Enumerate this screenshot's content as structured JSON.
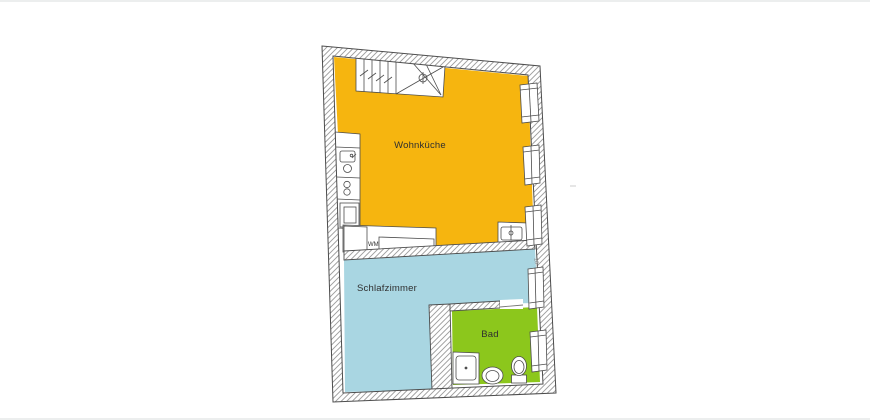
{
  "rooms": [
    {
      "label": "Wohnküche",
      "color": "#F6B50F"
    },
    {
      "label": "Schlafzimmer",
      "color": "#A9D6E2"
    },
    {
      "label": "Bad",
      "color": "#8CC71C"
    }
  ],
  "annotations": {
    "washing_machine": "WM",
    "wall_dimension": "28"
  },
  "colors": {
    "background": "#ffffff",
    "wall_hatch": "#9b9b9b",
    "outline": "#4d4d4d",
    "label_text": "#2f2f2f"
  },
  "fixtures": [
    "staircase-icon",
    "kitchen-sink-icon",
    "cooktop-icon",
    "kitchen-cabinet-icon",
    "washing-machine-icon",
    "wall-basin-icon",
    "shower-icon",
    "washbasin-icon",
    "toilet-icon",
    "window-icon"
  ]
}
